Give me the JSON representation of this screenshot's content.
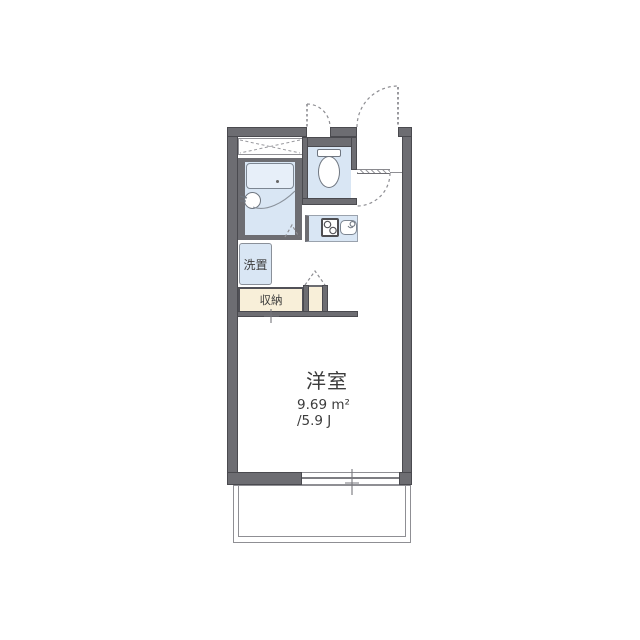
{
  "plan": {
    "type": "apartment-floorplan",
    "rooms": {
      "main_room": {
        "name_label": "洋室",
        "area_m2_label": "9.69 m²",
        "area_tatami_label": "/5.9 J"
      },
      "closet": {
        "name_label": "収納"
      },
      "washer_space": {
        "name_label": "洗置"
      }
    },
    "fixtures": [
      "bathtub",
      "washbasin",
      "toilet",
      "stove",
      "kitchen-sink",
      "entrance-door",
      "toilet-window",
      "toilet-door",
      "genkan-step",
      "folding-door-mark-bath",
      "folding-door-mark-closet",
      "bottom-window",
      "balcony"
    ],
    "colors": {
      "wall": "#6d6d72",
      "wall_edge": "#4a4a4f",
      "water_area_fill": "#d9e6f4",
      "tub_fill": "#e7eff9",
      "storage_fill": "#f8efd9",
      "thin_line": "#8f8f94",
      "text": "#3c3c3c",
      "background": "#ffffff"
    }
  }
}
